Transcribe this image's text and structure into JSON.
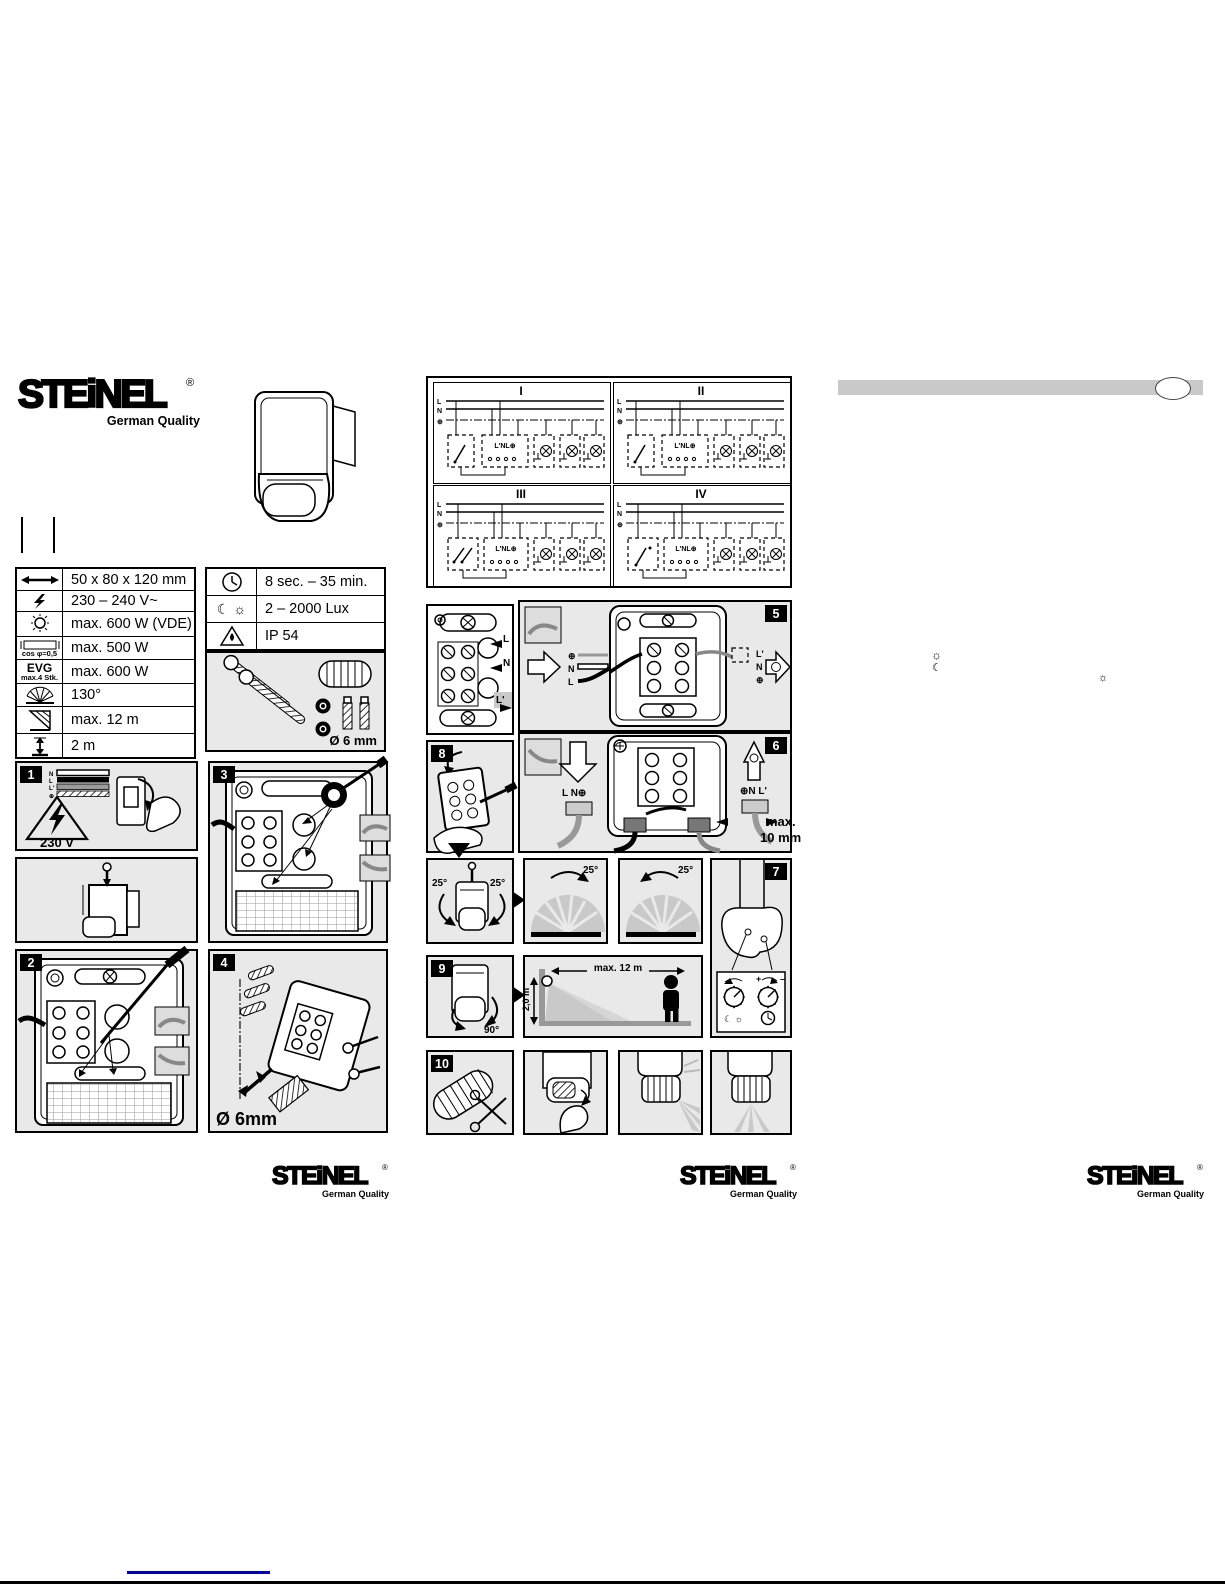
{
  "brand": {
    "word": "STEiNEL",
    "reg": "®",
    "tagline": "German Quality"
  },
  "colors": {
    "panel_bg": "#e9e9e9",
    "bar_gray": "#c9c9c9",
    "link_blue": "#0000bb"
  },
  "spec_left": {
    "rows": [
      {
        "value": "50 x 80 x 120 mm"
      },
      {
        "value": "230 – 240 V~"
      },
      {
        "value": "max. 600 W (VDE)"
      },
      {
        "value": "max. 500 W",
        "icon_label": "cos φ=0,5"
      },
      {
        "value": "max. 600 W",
        "icon_label": "EVG",
        "icon_sublabel": "max.4 Stk."
      },
      {
        "value": "130°"
      },
      {
        "value": "max. 12 m"
      },
      {
        "value": "2 m"
      }
    ]
  },
  "spec_right": {
    "rows": [
      {
        "value": "8 sec. – 35 min."
      },
      {
        "value": "2 – 2000 Lux"
      },
      {
        "value": "IP 54"
      }
    ]
  },
  "hardware": {
    "diameter": "Ø 6 mm"
  },
  "wiring": {
    "quadrants": [
      "I",
      "II",
      "III",
      "IV"
    ],
    "bus": [
      "L",
      "N",
      "⊕"
    ],
    "terminal": "L'NL⊕"
  },
  "terminal_panel": {
    "l": "L",
    "n": "N",
    "lp": "L'"
  },
  "steps": {
    "s1": {
      "no": "1",
      "voltage": "230 V",
      "legend": [
        "N",
        "L",
        "L'",
        "⊕"
      ]
    },
    "s2": {
      "no": "2"
    },
    "s3": {
      "no": "3"
    },
    "s4": {
      "no": "4",
      "drill": "Ø 6mm"
    },
    "s5": {
      "no": "5",
      "in_top": "⊕",
      "in_mid": "N",
      "in_bot": "L",
      "out_top": "L'",
      "out_mid": "N",
      "out_bot": "⊕"
    },
    "s6": {
      "no": "6",
      "in": "L N⊕",
      "out": "⊕N L'",
      "max1": "max.",
      "max2": "10 mm"
    },
    "s7": {
      "no": "7",
      "plus": "+",
      "minus": "–",
      "dusk": "☾ ☼"
    },
    "s8": {
      "no": "8"
    },
    "s9": {
      "no": "9",
      "angle": "90°"
    },
    "s10": {
      "no": "10"
    }
  },
  "rotation": {
    "left": "25°",
    "right": "25°",
    "fan1": "25°",
    "fan2": "25°"
  },
  "range": {
    "h": "max. 12 m",
    "v": "2,0 m"
  },
  "page_icons": {
    "sun": "☼",
    "moon": "☾"
  }
}
